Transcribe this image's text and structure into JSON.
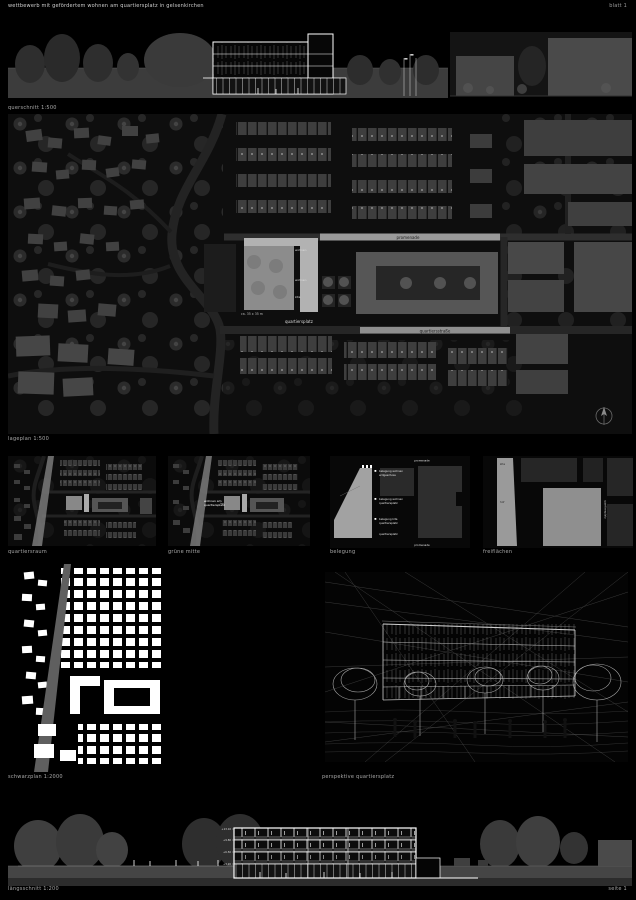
{
  "colors": {
    "background": "#000000",
    "panel_bg": "#0d0d0d",
    "building_gray": "#3f3f3f",
    "building_light": "#9e9e9e",
    "line_white": "#ffffff",
    "caption_gray": "#a9a9a9"
  },
  "header": {
    "title": "wettbewerb mit gefördertem wohnen am quartiersplatz in gelsenkirchen",
    "sheet": "blatt 1"
  },
  "panels": {
    "top_elevation": {
      "caption": "querschnitt 1:500"
    },
    "siteplan": {
      "caption": "lageplan 1:500",
      "labels": {
        "street_top": "promenade",
        "street_bottom": "quartiersstraße",
        "plaza": "quartiersplatz",
        "plaza_note": "ca. 35 x 35 m",
        "block_1": "wohnen",
        "block_2": "wohnen",
        "block_3": "kita"
      }
    },
    "mini_a": {
      "caption": "quartiersraum"
    },
    "mini_b": {
      "caption": "grüne mitte",
      "note_l1": "wohnen am",
      "note_l2": "quartiersplatz"
    },
    "belegung": {
      "caption": "belegung",
      "top_label": "promenade",
      "bottom_label": "promenade",
      "items": [
        {
          "l1": "belegung wohnen",
          "l2": "erdgeschoss"
        },
        {
          "l1": "belegung wohnen",
          "l2": "quartiersplatz"
        },
        {
          "l1": "belegung kita",
          "l2": "quartiersplatz"
        },
        {
          "l1": "quartiersplatz",
          "l2": ""
        }
      ]
    },
    "freiflaechen": {
      "caption": "freiflächen",
      "labels": {
        "wedge_top": "kita",
        "square": "quartiersplatz",
        "hof": "hof"
      }
    },
    "schwarzplan": {
      "caption": "schwarzplan 1:2000"
    },
    "perspective": {
      "caption": "perspektive quartiersplatz"
    },
    "bottom_section": {
      "caption": "längsschnitt 1:200",
      "levels": [
        "+13.10",
        "+9.80",
        "+6.50",
        "+3.20"
      ]
    }
  },
  "footer": {
    "page": "seite 1"
  }
}
